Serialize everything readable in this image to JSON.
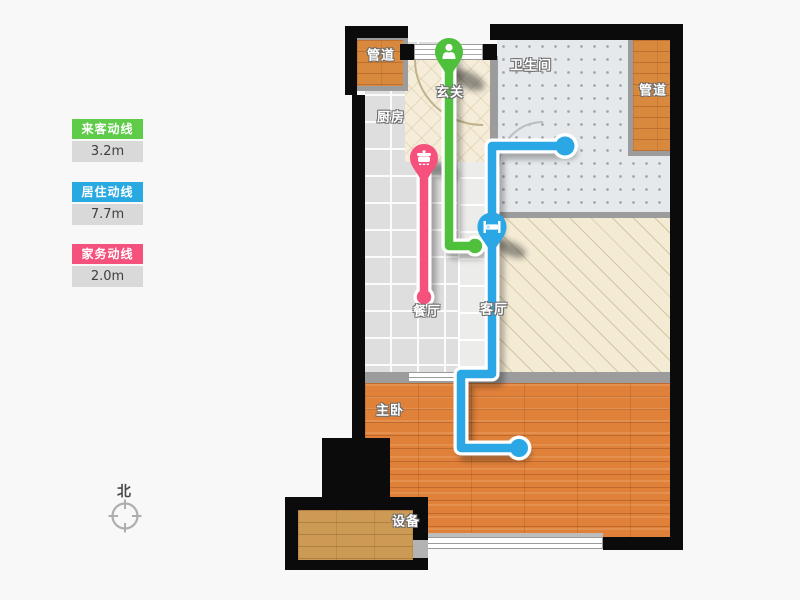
{
  "legend": {
    "items": [
      {
        "label": "来客动线",
        "value": "3.2m",
        "color": "#5ecb49"
      },
      {
        "label": "居住动线",
        "value": "7.7m",
        "color": "#29a9e2"
      },
      {
        "label": "家务动线",
        "value": "2.0m",
        "color": "#f4517c"
      }
    ]
  },
  "compass": {
    "label": "北"
  },
  "rooms": {
    "duct_top_left": "管道",
    "entrance": "玄关",
    "kitchen": "厨房",
    "bathroom": "卫生间",
    "duct_right": "管道",
    "dining": "餐厅",
    "living": "客厅",
    "bedroom": "主卧",
    "equipment": "设备"
  },
  "routes": [
    {
      "name": "guest-route",
      "label": "来客动线",
      "length": "3.2m",
      "color": "#4ec03c",
      "marker_icon": "person-icon"
    },
    {
      "name": "chore-route",
      "label": "家务动线",
      "length": "2.0m",
      "color": "#f4527d",
      "marker_icon": "cooking-pot-icon"
    },
    {
      "name": "resident-route",
      "label": "居住动线",
      "length": "7.7m",
      "color": "#2aa7e4",
      "marker_icon": "bed-icon"
    }
  ]
}
